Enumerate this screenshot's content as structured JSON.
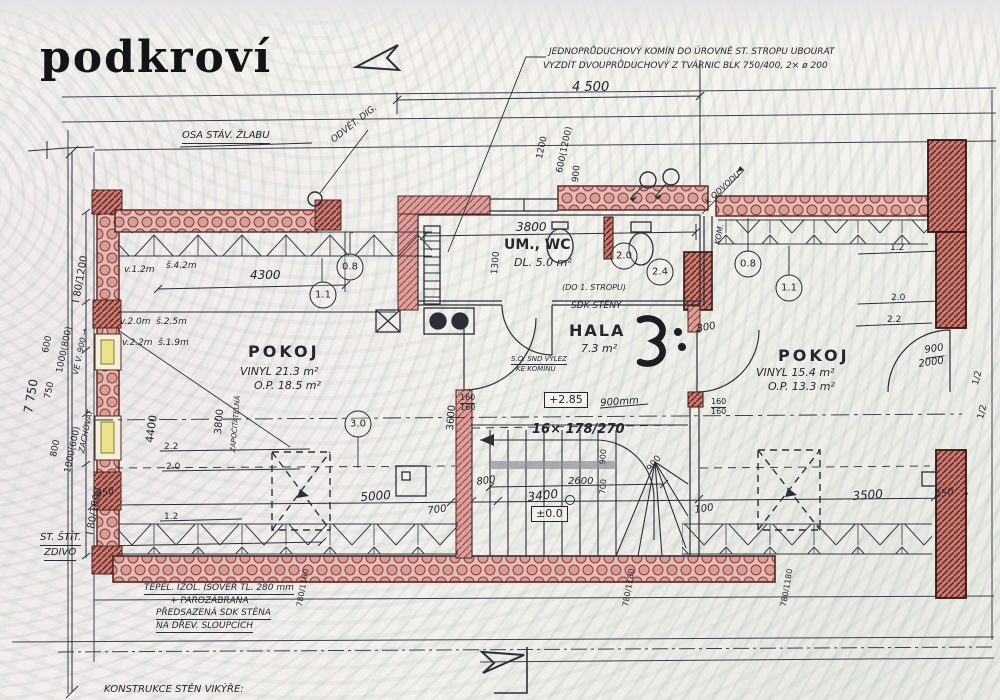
{
  "title": "podkroví",
  "colors": {
    "ink": "#2e2e36",
    "wall_brick": "#d9a09e",
    "wall_dark": "#c47b72",
    "insulation": "#e5bcb8",
    "window_glass": "#ece28a",
    "paper": "#f5f3ed"
  },
  "annotations": [
    {
      "name": "note-chimney-1",
      "text": "JEDNOPRŮDUCHOVÝ KOMÍN DO ÚROVNĚ ST. STROPU UBOURAT",
      "x": 549,
      "y": 48,
      "size": 9,
      "italic": 1
    },
    {
      "name": "note-chimney-2",
      "text": "VYZDÍT DVOUPRŮDUCHOVÝ Z TVÁRNIC BLK 750/400, 2× ø 200",
      "x": 543,
      "y": 62,
      "size": 9,
      "italic": 1
    },
    {
      "name": "dim-4500",
      "text": "4 500",
      "x": 572,
      "y": 81,
      "size": 13,
      "italic": 1
    },
    {
      "name": "note-gutter-axis",
      "text": "OSA STÁV. ŽLABU",
      "x": 182,
      "y": 131,
      "size": 10,
      "italic": 1,
      "underline": 1
    },
    {
      "name": "note-vent-hood",
      "text": "ODVĚT. DIG.",
      "x": 330,
      "y": 138,
      "size": 9,
      "rot": -38,
      "italic": 1
    },
    {
      "name": "dim-1200",
      "text": "1200",
      "x": 536,
      "y": 158,
      "size": 9,
      "rot": -78
    },
    {
      "name": "dim-600-1200",
      "text": "600(1200)",
      "x": 556,
      "y": 172,
      "size": 9,
      "rot": -78
    },
    {
      "name": "dim-900-top",
      "text": "900",
      "x": 572,
      "y": 182,
      "size": 9,
      "rot": -85
    },
    {
      "name": "dim-7750",
      "text": "7 750",
      "x": 22,
      "y": 412,
      "size": 12,
      "rot": -80
    },
    {
      "name": "dim-window-80-1200",
      "text": "I 80/1200",
      "x": 72,
      "y": 302,
      "size": 10,
      "rot": -80
    },
    {
      "name": "dim-600-left",
      "text": "600",
      "x": 42,
      "y": 352,
      "size": 9,
      "rot": -78
    },
    {
      "name": "dim-1000-800",
      "text": "1000(800)",
      "x": 56,
      "y": 372,
      "size": 9,
      "rot": -78
    },
    {
      "name": "note-sill-900",
      "text": "VE V. 900 →",
      "x": 72,
      "y": 374,
      "size": 8,
      "rot": -78,
      "italic": 1
    },
    {
      "name": "dim-750",
      "text": "750",
      "x": 44,
      "y": 398,
      "size": 9,
      "rot": -78
    },
    {
      "name": "dim-800-left",
      "text": "800",
      "x": 50,
      "y": 456,
      "size": 9,
      "rot": -78
    },
    {
      "name": "dim-1000-600",
      "text": "1000(600)",
      "x": 64,
      "y": 472,
      "size": 9,
      "rot": -78
    },
    {
      "name": "note-keep",
      "text": "ZACHOVAT",
      "x": 78,
      "y": 452,
      "size": 8,
      "rot": -78,
      "italic": 1
    },
    {
      "name": "dim-window-80-1800",
      "text": "I 80/1800",
      "x": 86,
      "y": 534,
      "size": 10,
      "rot": -80
    },
    {
      "name": "dim-450-left",
      "text": "450",
      "x": 96,
      "y": 491,
      "size": 9,
      "rot": -12,
      "italic": 1
    },
    {
      "name": "note-gable-1",
      "text": "ST. ŠTÍT.",
      "x": 40,
      "y": 533,
      "size": 10,
      "italic": 1,
      "underline": 1
    },
    {
      "name": "note-gable-2",
      "text": "ZDIVO",
      "x": 44,
      "y": 548,
      "size": 10,
      "italic": 1,
      "underline": 1
    },
    {
      "name": "dim-h12-left",
      "text": "v.1.2m",
      "x": 124,
      "y": 266,
      "size": 9,
      "italic": 1
    },
    {
      "name": "dim-s42-left",
      "text": "š.4.2m",
      "x": 166,
      "y": 262,
      "size": 9,
      "italic": 1
    },
    {
      "name": "dim-4300",
      "text": "4300",
      "x": 250,
      "y": 269,
      "size": 12,
      "italic": 1
    },
    {
      "name": "dim-h20-left",
      "text": "v.2.0m  š.2.5m",
      "x": 120,
      "y": 318,
      "size": 9,
      "italic": 1
    },
    {
      "name": "dim-h22-left",
      "text": "v.2.2m  š.1.9m",
      "x": 122,
      "y": 339,
      "size": 9,
      "italic": 1
    },
    {
      "name": "room-pokoj-left",
      "text": "POKOJ",
      "x": 248,
      "y": 344,
      "size": 16,
      "bold": 1,
      "ls": 3
    },
    {
      "name": "room-pokoj-left-floor",
      "text": "VINYL 21.3 m²",
      "x": 240,
      "y": 366,
      "size": 11,
      "italic": 1
    },
    {
      "name": "room-pokoj-left-area",
      "text": "O.P. 18.5 m²",
      "x": 254,
      "y": 380,
      "size": 11,
      "italic": 1
    },
    {
      "name": "dim-4400",
      "text": "4400",
      "x": 144,
      "y": 442,
      "size": 11,
      "rot": -82
    },
    {
      "name": "dim-3800-left",
      "text": "3800",
      "x": 214,
      "y": 434,
      "size": 10,
      "rot": -85
    },
    {
      "name": "note-countable",
      "text": "ZAPOČITATELNÁ",
      "x": 230,
      "y": 452,
      "size": 7,
      "rot": -85,
      "italic": 1
    },
    {
      "name": "dim-3600",
      "text": "3600",
      "x": 446,
      "y": 430,
      "size": 10,
      "rot": -85
    },
    {
      "name": "dim-160-160-a1",
      "text": "160",
      "x": 460,
      "y": 394,
      "size": 8,
      "underline": 1
    },
    {
      "name": "dim-160-160-a2",
      "text": "160",
      "x": 460,
      "y": 404,
      "size": 8
    },
    {
      "name": "dim-1300",
      "text": "1300",
      "x": 491,
      "y": 274,
      "size": 9,
      "rot": -85
    },
    {
      "name": "dim-3800-wc",
      "text": "3800",
      "x": 516,
      "y": 221,
      "size": 12,
      "italic": 1
    },
    {
      "name": "room-umwc",
      "text": "UM., WC",
      "x": 504,
      "y": 238,
      "size": 14,
      "bold": 1
    },
    {
      "name": "room-umwc-area",
      "text": "DL. 5.0 m²",
      "x": 514,
      "y": 257,
      "size": 11,
      "italic": 1
    },
    {
      "name": "note-to-ceiling",
      "text": "(DO 1. STROPU)",
      "x": 562,
      "y": 284,
      "size": 8,
      "italic": 1
    },
    {
      "name": "note-sdk-walls",
      "text": "SDK STĚNY",
      "x": 571,
      "y": 302,
      "size": 9,
      "italic": 1
    },
    {
      "name": "room-hala",
      "text": "HALA",
      "x": 569,
      "y": 323,
      "size": 16,
      "bold": 1,
      "ls": 2
    },
    {
      "name": "room-hala-area",
      "text": "7.3 m²",
      "x": 581,
      "y": 343,
      "size": 11,
      "italic": 1
    },
    {
      "name": "note-hatch-1",
      "text": "S.O. SND VÝLEZ",
      "x": 511,
      "y": 356,
      "size": 7,
      "italic": 1,
      "underline": 1
    },
    {
      "name": "note-hatch-2",
      "text": "KE KOMÍNU",
      "x": 516,
      "y": 366,
      "size": 7,
      "italic": 1
    },
    {
      "name": "level-285",
      "text": "+2.85",
      "x": 544,
      "y": 392,
      "size": 11,
      "box": 1
    },
    {
      "name": "dim-900mm",
      "text": "900mm",
      "x": 600,
      "y": 399,
      "size": 10,
      "rot": -4,
      "italic": 1
    },
    {
      "name": "stair-formula",
      "text": "16× 178/270",
      "x": 532,
      "y": 423,
      "size": 13,
      "bold": 1,
      "italic": 1
    },
    {
      "name": "dim-900-winder",
      "text": "900",
      "x": 646,
      "y": 468,
      "size": 9,
      "rot": -52
    },
    {
      "name": "dim-900-tread",
      "text": "900",
      "x": 599,
      "y": 464,
      "size": 8,
      "rot": -85
    },
    {
      "name": "dim-700-tread",
      "text": "700",
      "x": 599,
      "y": 494,
      "size": 8,
      "rot": -85
    },
    {
      "name": "dim-2600",
      "text": "2600",
      "x": 568,
      "y": 477,
      "size": 10,
      "italic": 1
    },
    {
      "name": "dim-800-stair",
      "text": "800",
      "x": 476,
      "y": 478,
      "size": 10,
      "rot": -8,
      "italic": 1
    },
    {
      "name": "dim-3400",
      "text": "3400",
      "x": 527,
      "y": 491,
      "size": 12,
      "rot": -6,
      "italic": 1
    },
    {
      "name": "level-000",
      "text": "±0.0",
      "x": 531,
      "y": 506,
      "size": 11,
      "box": 1
    },
    {
      "name": "dim-100-mid",
      "text": "100",
      "x": 694,
      "y": 506,
      "size": 10,
      "rot": -8,
      "italic": 1
    },
    {
      "name": "dim-5000",
      "text": "5000",
      "x": 360,
      "y": 491,
      "size": 12,
      "rot": -4,
      "italic": 1
    },
    {
      "name": "dim-700-left",
      "text": "700",
      "x": 427,
      "y": 507,
      "size": 10,
      "rot": -8,
      "italic": 1
    },
    {
      "name": "dim-22-left",
      "text": "2.2",
      "x": 164,
      "y": 443,
      "size": 9
    },
    {
      "name": "dim-20-left",
      "text": "2.0",
      "x": 166,
      "y": 463,
      "size": 9
    },
    {
      "name": "dim-12-left",
      "text": "1.2",
      "x": 164,
      "y": 513,
      "size": 9
    },
    {
      "name": "dim-780-1180-a",
      "text": "780/1180",
      "x": 296,
      "y": 606,
      "size": 8,
      "rot": -80
    },
    {
      "name": "dim-780-1180-b",
      "text": "780/1180",
      "x": 622,
      "y": 606,
      "size": 8,
      "rot": -80
    },
    {
      "name": "dim-780-1180-c",
      "text": "780/1180",
      "x": 780,
      "y": 606,
      "size": 8,
      "rot": -80
    },
    {
      "name": "note-insul-1",
      "text": "TEPEL. IZOL. ISOVER TL. 280 mm",
      "x": 144,
      "y": 584,
      "size": 9,
      "italic": 1,
      "underline": 1
    },
    {
      "name": "note-insul-2",
      "text": "+ PAROZÁBRANA",
      "x": 170,
      "y": 597,
      "size": 9,
      "italic": 1
    },
    {
      "name": "note-insul-3",
      "text": "PŘEDSAZENÁ SDK STĚNA",
      "x": 156,
      "y": 609,
      "size": 9,
      "italic": 1,
      "underline": 1
    },
    {
      "name": "note-insul-4",
      "text": "NA DŘEV. SLOUPCÍCH",
      "x": 156,
      "y": 622,
      "size": 9,
      "italic": 1,
      "underline": 1
    },
    {
      "name": "note-dormer-walls",
      "text": "KONSTRUKCE STĚN VIKÝŘE:",
      "x": 104,
      "y": 685,
      "size": 10,
      "italic": 1
    },
    {
      "name": "room-pokoj-right",
      "text": "POKOJ",
      "x": 778,
      "y": 348,
      "size": 16,
      "bold": 1,
      "ls": 3
    },
    {
      "name": "room-pokoj-right-floor",
      "text": "VINYL 15.4 m²",
      "x": 756,
      "y": 367,
      "size": 11,
      "italic": 1
    },
    {
      "name": "room-pokoj-right-area",
      "text": "O.P. 13.3 m²",
      "x": 768,
      "y": 381,
      "size": 11,
      "italic": 1
    },
    {
      "name": "dim-12-right",
      "text": "1.2",
      "x": 890,
      "y": 244,
      "size": 9
    },
    {
      "name": "dim-20-right",
      "text": "2.0",
      "x": 891,
      "y": 294,
      "size": 9
    },
    {
      "name": "dim-22-right",
      "text": "2.2",
      "x": 887,
      "y": 316,
      "size": 9
    },
    {
      "name": "dim-door-900",
      "text": "900",
      "x": 924,
      "y": 346,
      "size": 10,
      "rot": -8,
      "italic": 1,
      "underline": 1
    },
    {
      "name": "dim-door-2000",
      "text": "2000",
      "x": 918,
      "y": 360,
      "size": 10,
      "rot": -8,
      "italic": 1
    },
    {
      "name": "dim-half-a",
      "text": "1/2",
      "x": 972,
      "y": 384,
      "size": 9,
      "rot": -75
    },
    {
      "name": "dim-half-b",
      "text": "1/2",
      "x": 977,
      "y": 418,
      "size": 9,
      "rot": -75
    },
    {
      "name": "dim-800-hala",
      "text": "800",
      "x": 696,
      "y": 325,
      "size": 10,
      "rot": -10,
      "italic": 1
    },
    {
      "name": "dim-160-160-b1",
      "text": "160",
      "x": 711,
      "y": 398,
      "size": 8,
      "underline": 1
    },
    {
      "name": "dim-160-160-b2",
      "text": "160",
      "x": 711,
      "y": 408,
      "size": 8
    },
    {
      "name": "dim-3500",
      "text": "3500",
      "x": 852,
      "y": 490,
      "size": 12,
      "rot": -4,
      "italic": 1
    },
    {
      "name": "dim-450-right",
      "text": "450",
      "x": 934,
      "y": 491,
      "size": 10,
      "rot": -10,
      "italic": 1
    },
    {
      "name": "note-kom",
      "text": "KOM.",
      "x": 714,
      "y": 244,
      "size": 8,
      "rot": -80,
      "italic": 1
    },
    {
      "name": "note-k-odvodu",
      "text": "K ODVODU",
      "x": 704,
      "y": 200,
      "size": 8,
      "rot": -42,
      "italic": 1
    }
  ],
  "circled_values": [
    {
      "name": "height-circle-11-left",
      "text": "1.1",
      "x": 323,
      "y": 295
    },
    {
      "name": "height-circle-08-left",
      "text": "0.8",
      "x": 350,
      "y": 267
    },
    {
      "name": "height-circle-30-left",
      "text": "3.0",
      "x": 358,
      "y": 424
    },
    {
      "name": "height-circle-20-wc",
      "text": "2.0",
      "x": 624,
      "y": 256
    },
    {
      "name": "height-circle-24-wc",
      "text": "2.4",
      "x": 660,
      "y": 272
    },
    {
      "name": "height-circle-08-right",
      "text": "0.8",
      "x": 748,
      "y": 264
    },
    {
      "name": "height-circle-11-right",
      "text": "1.1",
      "x": 789,
      "y": 288
    }
  ]
}
